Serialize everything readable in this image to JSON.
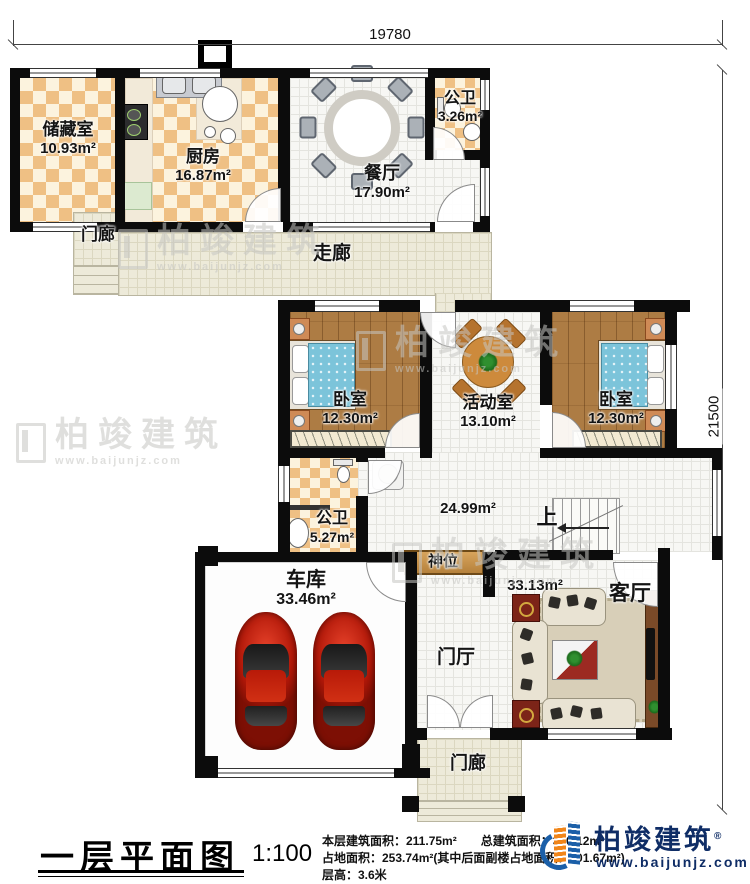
{
  "dims": {
    "top": "19780",
    "right": "21500"
  },
  "rooms": {
    "storage": {
      "name": "储藏室",
      "area": "10.93m²"
    },
    "kitchen": {
      "name": "厨房",
      "area": "16.87m²"
    },
    "dining": {
      "name": "餐厅",
      "area": "17.90m²"
    },
    "bath1": {
      "name": "公卫",
      "area": "3.26m²"
    },
    "porch1": {
      "name": "门廊"
    },
    "corridor": {
      "name": "走廊"
    },
    "bedroom1": {
      "name": "卧室",
      "area": "12.30m²"
    },
    "activity": {
      "name": "活动室",
      "area": "13.10m²"
    },
    "bedroom2": {
      "name": "卧室",
      "area": "12.30m²"
    },
    "bath2": {
      "name": "公卫",
      "area": "5.27m²"
    },
    "hall": {
      "area": "24.99m²"
    },
    "stairs": {
      "label": "上"
    },
    "shrine": {
      "name": "神位"
    },
    "garage": {
      "name": "车库",
      "area": "33.46m²"
    },
    "living": {
      "name": "客厅",
      "area": "33.13m²"
    },
    "foyer": {
      "name": "门厅"
    },
    "porch2": {
      "name": "门廊"
    }
  },
  "titleblock": {
    "title": "一层平面图",
    "scale": "1:100",
    "stats1": "本层建筑面积：211.75m²　　总建筑面积：330.12m²",
    "stats2": "占地面积：253.74m²(其中后面副楼占地面积：101.67m²)",
    "stats3": "层高：3.6米"
  },
  "brand": {
    "name": "柏竣建筑",
    "reg": "®",
    "url": "www.baijunjz.com"
  },
  "watermark": {
    "name": "柏竣建筑",
    "url": "www.baijunjz.com"
  },
  "colors": {
    "wall": "#0c0c0c",
    "brand_blue": "#1b5fa8",
    "brand_orange": "#f08519",
    "car_red": "#b01708"
  }
}
